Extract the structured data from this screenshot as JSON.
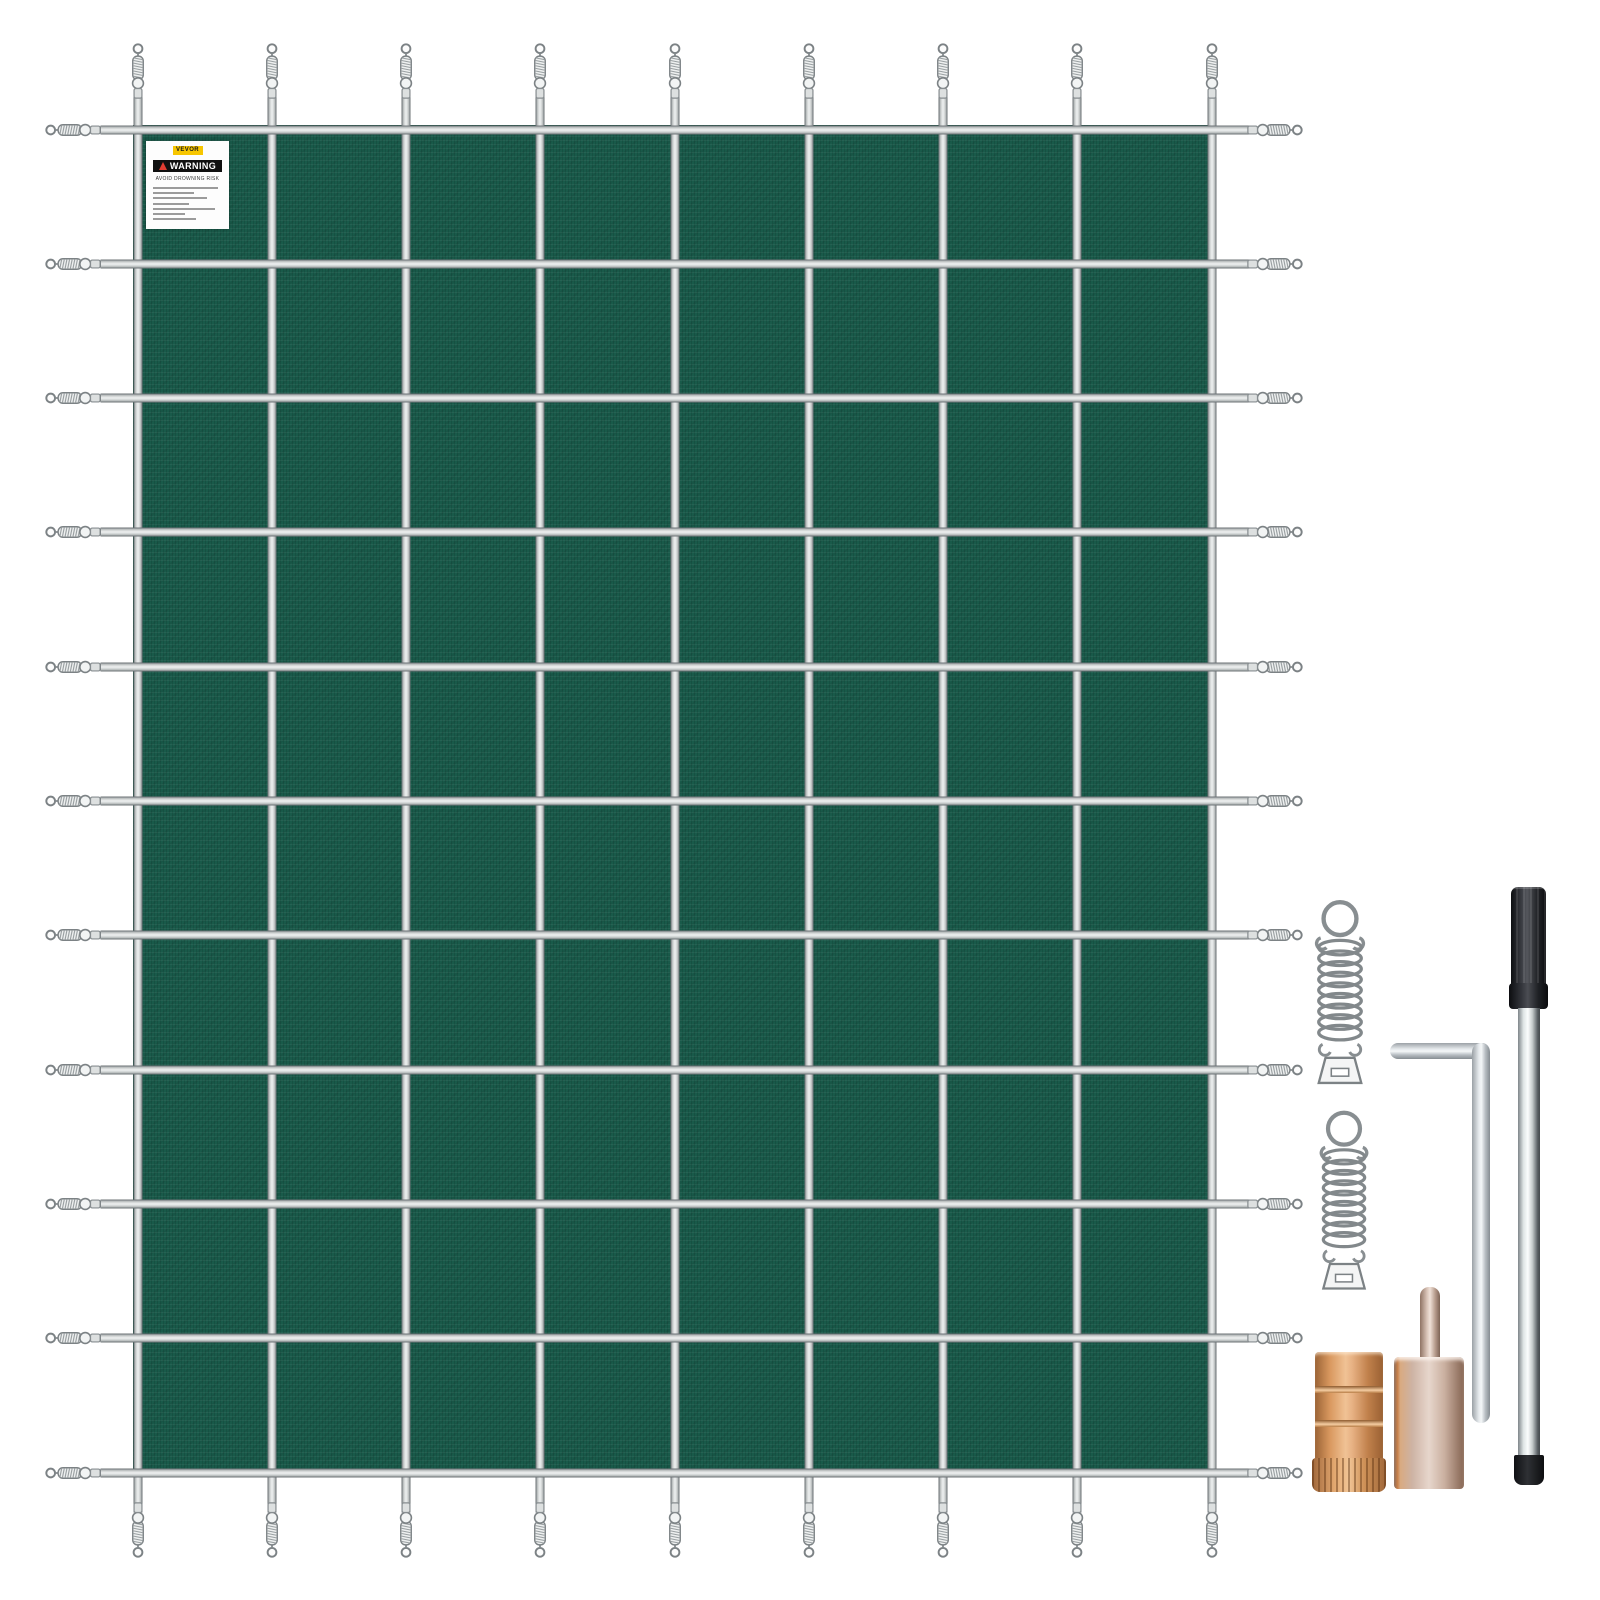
{
  "page": {
    "background": "#ffffff"
  },
  "cover": {
    "columns": 8,
    "rows": 10,
    "vertical_straps": 9,
    "horizontal_straps": 11,
    "springs": {
      "top": 9,
      "bottom": 9,
      "left": 11,
      "right": 11
    },
    "fabric_color": "#195a4a",
    "strap_color": "#c9cdcd",
    "spring_color": "#82888b"
  },
  "warning_label": {
    "brand": "VEVOR",
    "heading": "WARNING",
    "subheading": "AVOID DROWNING RISK",
    "fine_print_lines": 7,
    "brand_bg": "#f7c600",
    "banner_bg": "#101010",
    "triangle_color": "#e03c31"
  },
  "hardware": {
    "icons": [
      "tension-spring-icon",
      "tension-spring-icon",
      "hex-key-icon",
      "installation-rod-icon",
      "brass-anchor-icon",
      "pin-anchor-icon"
    ],
    "colors": {
      "brass": "#d99a63",
      "champagne": "#cfb6a8",
      "chrome_light": "#f4f7f8",
      "chrome_dark": "#5d6366",
      "black": "#17181b",
      "steel": "#b9bfc3"
    }
  }
}
